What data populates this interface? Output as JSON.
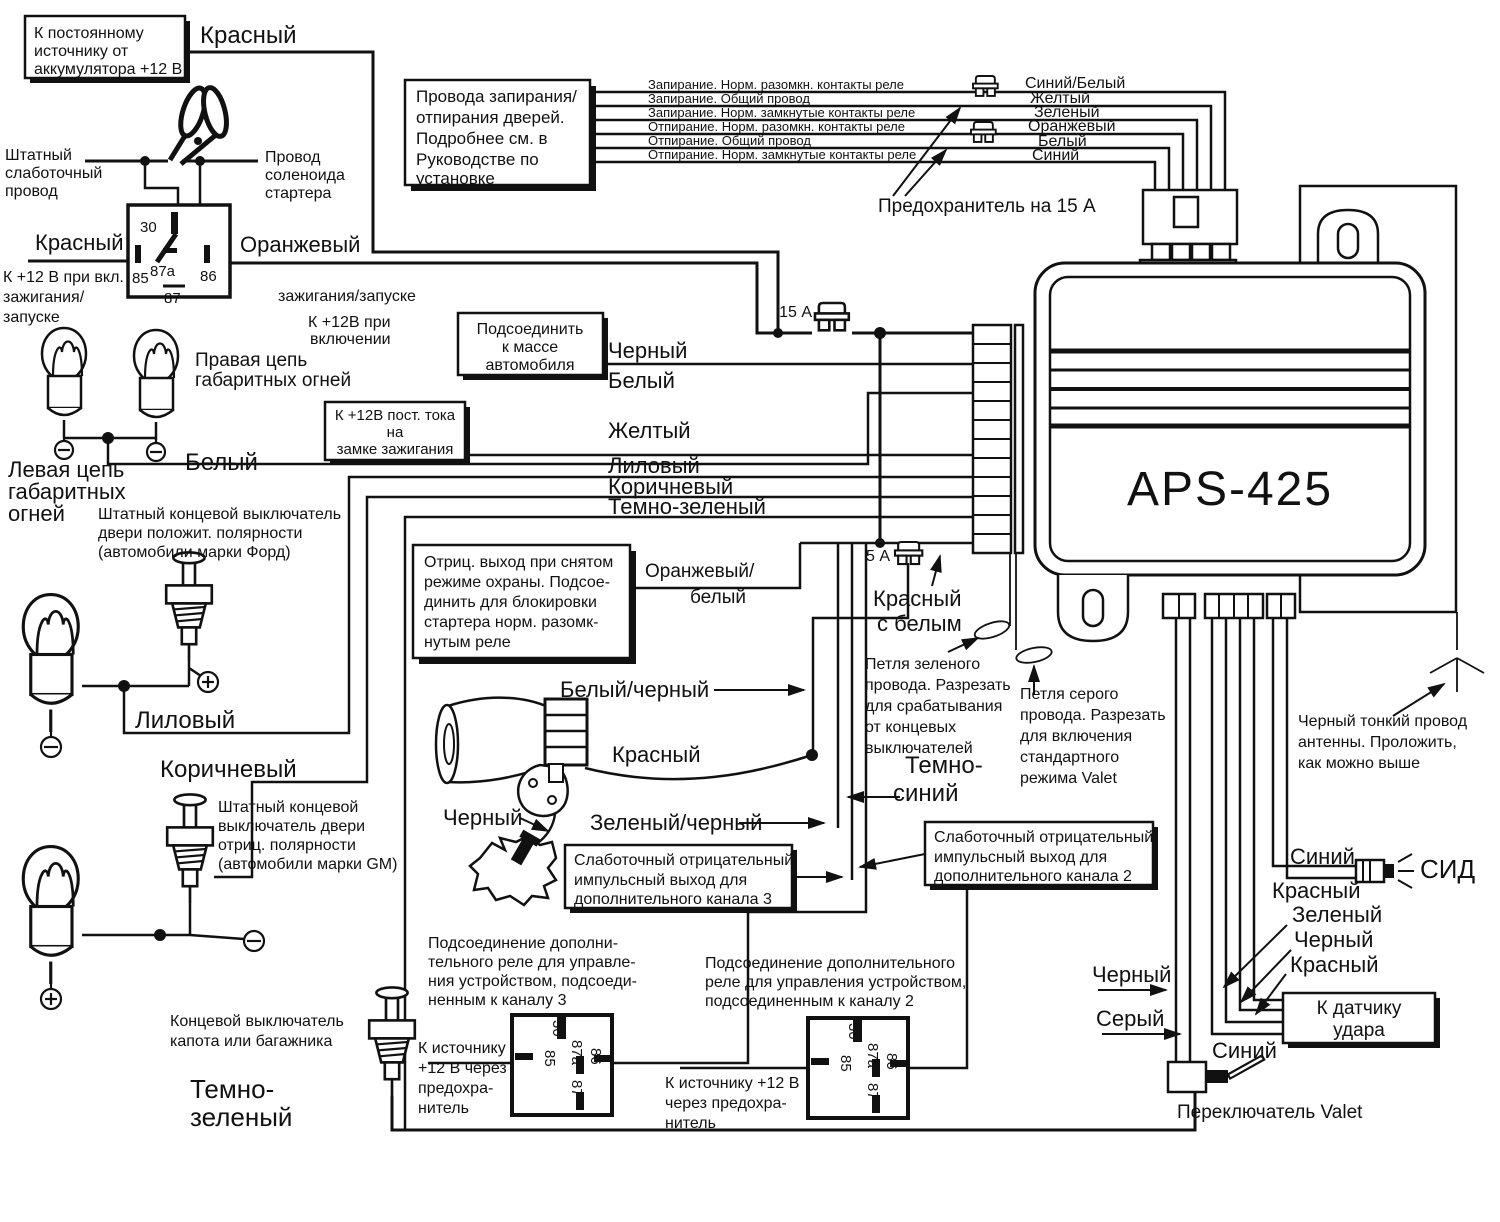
{
  "unit": {
    "model": "APS-425"
  },
  "boxes": {
    "battery": [
      "К постоянному",
      "источнику от",
      "аккумулятора +12 В"
    ],
    "lock": [
      "Провода запирания/",
      "отпирания дверей.",
      "Подробнее см. в",
      "Руководстве по",
      "установке"
    ],
    "lock_wires": [
      "Запирание. Норм. разомкн. контакты реле",
      "Запирание. Общий провод",
      "Запирание. Норм. замкнутые контакты реле",
      "Отпирание. Норм. разомкн. контакты реле",
      "Отпирание. Общий провод",
      "Отпирание. Норм. замкнутые контакты реле"
    ],
    "lock_colors": [
      "Синий/Белый",
      "Желтый",
      "Зеленый",
      "Оранжевый",
      "Белый",
      "Синий"
    ],
    "ground": [
      "Подсоединить",
      "к массе",
      "автомобиля"
    ],
    "ignition12": [
      "К +12В пост. тока",
      "на",
      "замке зажигания"
    ],
    "neg_output": [
      "Отриц. выход при снятом",
      "режиме охраны. Подсое-",
      "динить для блокировки",
      "стартера норм. разомк-",
      "нутым реле"
    ],
    "ch3": [
      "Слаботочный отрицательный",
      "импульсный выход  для",
      "дополнительного канала 3"
    ],
    "ch2": [
      "Слаботочный отрицательный",
      "импульсный выход  для",
      "дополнительного канала 2"
    ],
    "shock": [
      "К датчику",
      "удара"
    ]
  },
  "wire_labels": {
    "red_top": "Красный",
    "red_ign": "Красный",
    "orange": "Оранжевый",
    "black_mid": "Черный",
    "white_mid": "Белый",
    "yellow": "Желтый",
    "lilac_mid": "Лиловый",
    "brown_mid": "Коричневый",
    "darkgreen_mid": "Темно-зеленый",
    "white_left": "Белый",
    "orange_white": [
      "Оранжевый/",
      "белый"
    ],
    "red_white": [
      "Красный",
      "с белым"
    ],
    "white_black": "Белый/черный",
    "siren_red": "Красный",
    "siren_black": "Черный",
    "green_black": "Зеленый/черный",
    "dark_blue": [
      "Темно-",
      "синий"
    ],
    "lilac_left": "Лиловый",
    "brown_left": "Коричневый",
    "darkgreen_left": [
      "Темно-",
      "зеленый"
    ],
    "valet_black": "Черный",
    "valet_gray": "Серый",
    "valet_blue": "Синий",
    "led_blue": "Синий",
    "led_red": "Красный",
    "shock_green": "Зеленый",
    "shock_black": "Черный",
    "shock_red": "Красный"
  },
  "notes": {
    "stock_wire": [
      "Штатный",
      "слаботочный",
      "провод"
    ],
    "solenoid": [
      "Провод",
      "соленоида",
      "стартера"
    ],
    "ign_on": [
      "К +12 В при вкл.",
      "зажигания/",
      "запуске"
    ],
    "ign_on2": [
      "зажигания/запуске",
      "К +12В при",
      "включении"
    ],
    "right_chain": [
      "Правая цепь",
      "габаритных огней"
    ],
    "left_chain": [
      "Левая цепь",
      "габаритных",
      "огней"
    ],
    "ford": [
      "Штатный концевой выключатель",
      "двери положит. полярности",
      "(автомобили марки Форд)"
    ],
    "gm": [
      "Штатный концевой",
      "выключатель двери",
      "отриц. полярности",
      "(автомобили марки GM)"
    ],
    "hood": [
      "Концевой выключатель",
      "капота или багажника"
    ],
    "fuse15": "Предохранитель на 15 А",
    "fuse15a": "15 А",
    "fuse5a": "5 А",
    "loop_green": [
      "Петля зеленого",
      "провода. Разрезать",
      "для срабатывания",
      "от концевых",
      "выключателей"
    ],
    "loop_gray": [
      "Петля серого",
      "провода. Разрезать",
      "для включения",
      "стандартного",
      "режима Valet"
    ],
    "antenna": [
      "Черный тонкий провод",
      "антенны. Проложить,",
      "как можно выше"
    ],
    "relay3_caption": [
      "Подсоединение дополни-",
      "тельного реле для управле-",
      "ния устройством, подсоеди-",
      "ненным к каналу 3"
    ],
    "relay3_src": [
      "К источнику",
      "+12 В через",
      "предохра-",
      "нитель"
    ],
    "relay2_caption": [
      "Подсоединение дополнительного",
      "реле для управления устройством,",
      "подсоединенным к каналу 2"
    ],
    "relay2_src": [
      "К источнику +12 В",
      "через предохра-",
      "нитель"
    ],
    "valet": "Переключатель Valet",
    "led": "СИД"
  },
  "relay_pins": {
    "p30": "30",
    "p87a": "87a",
    "p85": "85",
    "p86": "86",
    "p87": "87"
  }
}
